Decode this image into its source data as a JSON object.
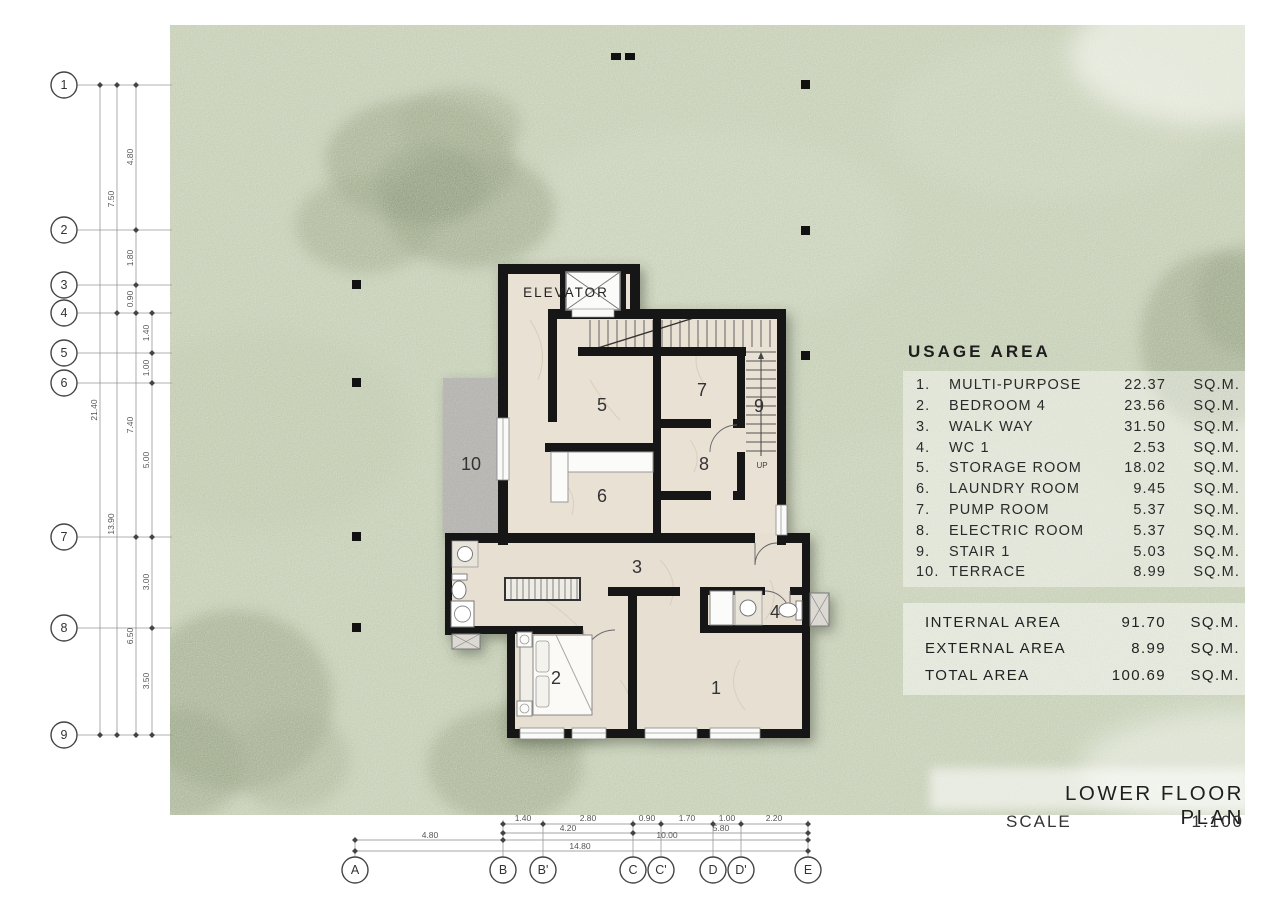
{
  "watermark": {
    "text": "samphoas.com"
  },
  "title_block": {
    "title": "LOWER FLOOR PLAN",
    "scale_label": "SCALE",
    "scale_value": "1:100"
  },
  "usage_area": {
    "heading": "USAGE AREA",
    "rows": [
      {
        "no": "1.",
        "name": "MULTI-PURPOSE",
        "area": "22.37",
        "unit": "SQ.M."
      },
      {
        "no": "2.",
        "name": "BEDROOM 4",
        "area": "23.56",
        "unit": "SQ.M."
      },
      {
        "no": "3.",
        "name": "WALK WAY",
        "area": "31.50",
        "unit": "SQ.M."
      },
      {
        "no": "4.",
        "name": "WC 1",
        "area": "2.53",
        "unit": "SQ.M."
      },
      {
        "no": "5.",
        "name": "STORAGE ROOM",
        "area": "18.02",
        "unit": "SQ.M."
      },
      {
        "no": "6.",
        "name": "LAUNDRY ROOM",
        "area": "9.45",
        "unit": "SQ.M."
      },
      {
        "no": "7.",
        "name": "PUMP ROOM",
        "area": "5.37",
        "unit": "SQ.M."
      },
      {
        "no": "8.",
        "name": "ELECTRIC ROOM",
        "area": "5.37",
        "unit": "SQ.M."
      },
      {
        "no": "9.",
        "name": "STAIR 1",
        "area": "5.03",
        "unit": "SQ.M."
      },
      {
        "no": "10.",
        "name": "TERRACE",
        "area": "8.99",
        "unit": "SQ.M."
      }
    ],
    "totals": [
      {
        "name": "INTERNAL AREA",
        "area": "91.70",
        "unit": "SQ.M."
      },
      {
        "name": "EXTERNAL AREA",
        "area": "8.99",
        "unit": "SQ.M."
      },
      {
        "name": "TOTAL AREA",
        "area": "100.69",
        "unit": "SQ.M."
      }
    ]
  },
  "plan": {
    "elevator_label": "ELEVATOR",
    "up_label": "UP",
    "rooms": [
      {
        "number": "1"
      },
      {
        "number": "2"
      },
      {
        "number": "3"
      },
      {
        "number": "4"
      },
      {
        "number": "5"
      },
      {
        "number": "6"
      },
      {
        "number": "7"
      },
      {
        "number": "8"
      },
      {
        "number": "9"
      },
      {
        "number": "10"
      }
    ]
  },
  "grid": {
    "left_labels": [
      "1",
      "2",
      "3",
      "4",
      "5",
      "6",
      "7",
      "8",
      "9"
    ],
    "bottom_labels": [
      "A",
      "B",
      "B'",
      "C",
      "C'",
      "D",
      "D'",
      "E"
    ]
  },
  "dimensions": {
    "left": [
      "21.40",
      "7.50",
      "13.90",
      "4.80",
      "1.80",
      "0.90",
      "7.40",
      "6.50",
      "1.40",
      "1.00",
      "5.00",
      "3.00",
      "3.50"
    ],
    "bottom": [
      "1.40",
      "2.80",
      "0.90",
      "1.70",
      "1.00",
      "2.20",
      "4.20",
      "5.80",
      "4.80",
      "10.00",
      "14.80"
    ]
  },
  "colors": {
    "grass": "#b3bfa2",
    "tree": "#74845f",
    "floor": "#e9e1d4",
    "terrace": "#a3a2a0",
    "wall": "#181818"
  }
}
